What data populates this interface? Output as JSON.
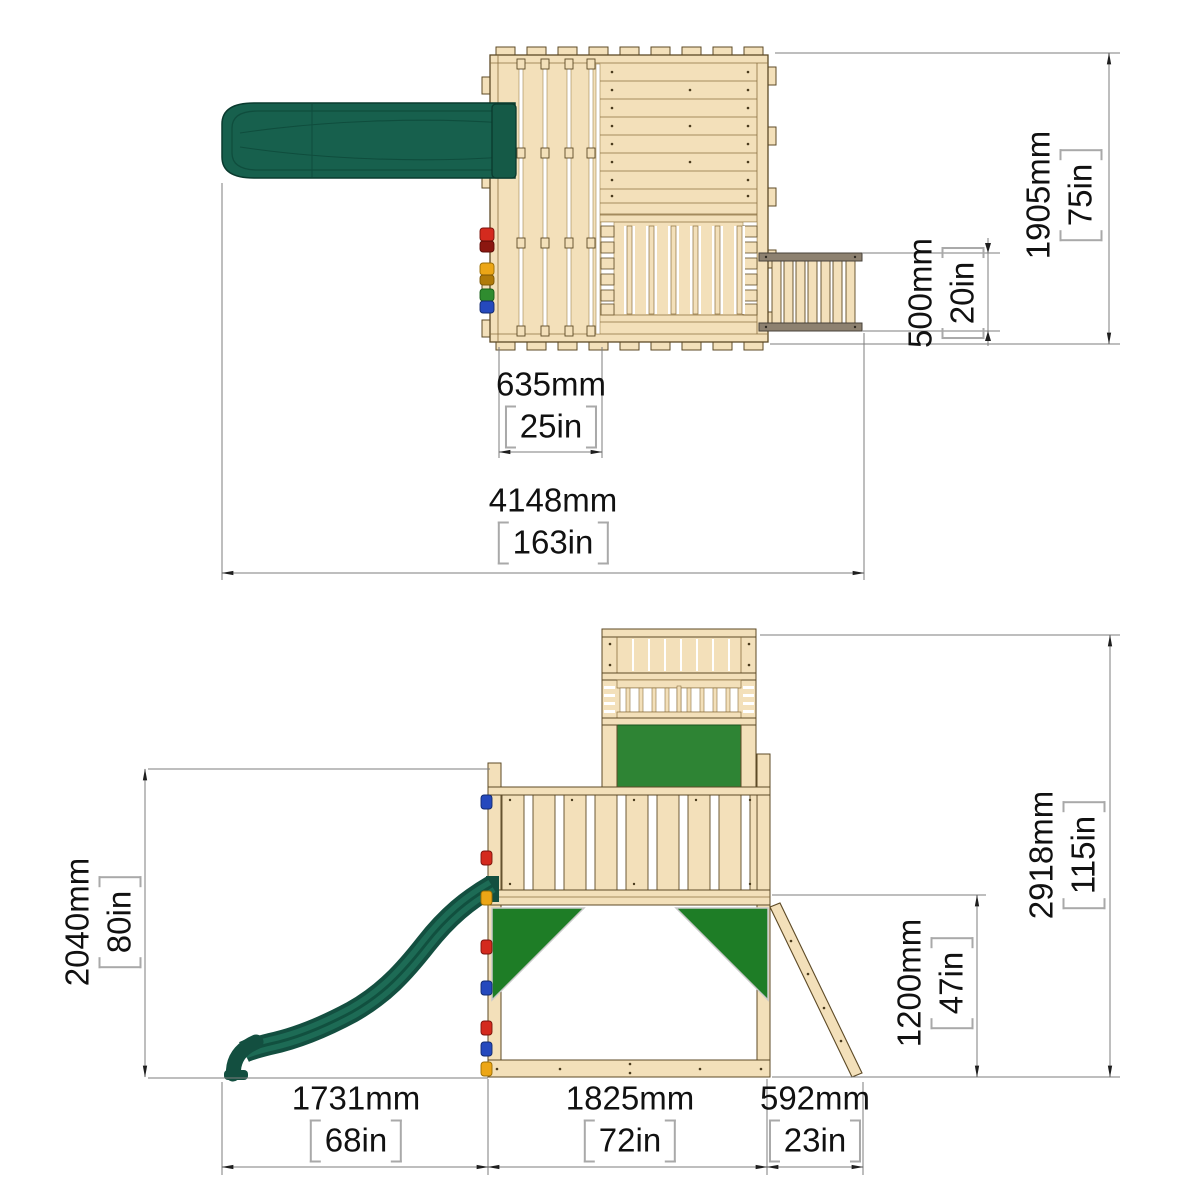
{
  "drawing": {
    "type": "product-dimension-diagram",
    "subject": "wooden climbing frame with slide, balcony and ladder",
    "views": [
      "top-view",
      "side-view"
    ]
  },
  "colors": {
    "wood": "#f3e0ba",
    "wood_outline": "#5d4a26",
    "rail_dark": "#8d8170",
    "slide_green": "#17604d",
    "panel_green": "#2e8434",
    "tarp_green": "#1e7d26",
    "dim_line": "#7d7d7d",
    "bracket": "#a9a9a9",
    "text": "#111111",
    "hold_red": "#d42a1e",
    "hold_yellow": "#eca616",
    "hold_blue": "#2549bd",
    "hold_green": "#2f8c2f"
  },
  "top_view": {
    "dims": {
      "deck_section_width": {
        "mm": "635mm",
        "in": "25in"
      },
      "overall_width": {
        "mm": "4148mm",
        "in": "163in"
      },
      "balcony_depth": {
        "mm": "500mm",
        "in": "20in"
      },
      "overall_depth": {
        "mm": "1905mm",
        "in": "75in"
      }
    }
  },
  "side_view": {
    "dims": {
      "slide_footprint": {
        "mm": "1731mm",
        "in": "68in"
      },
      "frame_width": {
        "mm": "1825mm",
        "in": "72in"
      },
      "ladder_footprint": {
        "mm": "592mm",
        "in": "23in"
      },
      "platform_height": {
        "mm": "2040mm",
        "in": "80in"
      },
      "overall_height": {
        "mm": "2918mm",
        "in": "115in"
      },
      "underdeck_height": {
        "mm": "1200mm",
        "in": "47in"
      }
    }
  }
}
